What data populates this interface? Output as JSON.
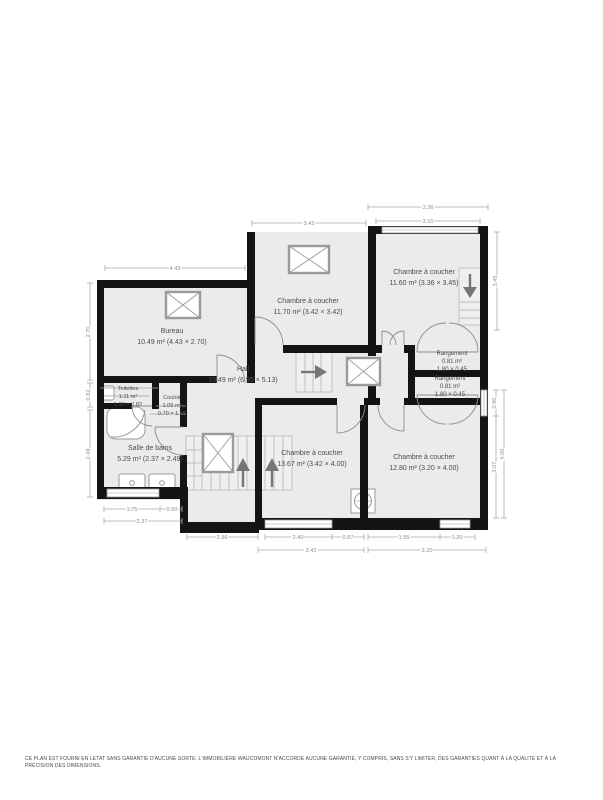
{
  "plan": {
    "rooms": [
      {
        "name": "Bureau",
        "area": "10.49 m² (4.43 × 2.70)"
      },
      {
        "name": "Chambre à coucher",
        "area": "11.70 m² (3.42 × 3.42)"
      },
      {
        "name": "Chambre à coucher",
        "area": "11.60 m² (3.36 × 3.45)"
      },
      {
        "name": "Hall",
        "area": "15.49 m² (6.95 × 5.13)"
      },
      {
        "name": "Rangement",
        "area": "0.81 m²",
        "dims": "1.80 × 0.45"
      },
      {
        "name": "Rangement",
        "area": "0.81 m²",
        "dims": "1.80 × 0.45"
      },
      {
        "name": "Toilettes",
        "area": "1.11 m²",
        "dims": "1.35 × 0.82"
      },
      {
        "name": "Couloir",
        "area": "1.09 m²",
        "dims": "0.70 × 1.56"
      },
      {
        "name": "Salle de bains",
        "area": "5.29 m² (2.37 × 2.49)"
      },
      {
        "name": "Chambre à coucher",
        "area": "13.67 m² (3.42 × 4.00)"
      },
      {
        "name": "Chambre à coucher",
        "area": "12.80 m² (3.20 × 4.00)"
      }
    ],
    "dimensions": {
      "bureau_top": "4.43",
      "ch2_top": "3.42",
      "ch3_outer": "3.36",
      "ch3_inner": "3.10",
      "ch3_right": "3.45",
      "bureau_left": "2.70",
      "toilettes_left": "0.82",
      "bath_left": "2.49",
      "bath_bottom1": "1.75",
      "bath_bottom2": "0.50",
      "bath_bottom_total": "2.37",
      "stair_bottom": "2.96",
      "ch4_win": "2.40",
      "ch4_wall": "0.87",
      "ch5_wall": "1.95",
      "ch5_win": "1.20",
      "ch4_total": "3.42",
      "ch5_total": "3.20",
      "right_win": "0.80",
      "right_lower": "3.07",
      "right_total": "4.00"
    },
    "colors": {
      "wall": "#141414",
      "room_fill": "#ebebeb",
      "dim_text": "#8c8c8c",
      "label_text": "#4c4c4c"
    }
  },
  "footer": {
    "disclaimer": "CE PLAN EST FOURNI EN LETAT SANS GARANTIE D'AUCUNE SORTE. L'IMMOBILIÈRE WAUCOMONT N'ACCORDE AUCUNE GARANTIE, Y COMPRIS, SANS S'Y LIMITER, DES GARANTIES QUANT À LA QUALITÉ ET À LA PRÉCISION DES DIMENSIONS."
  }
}
